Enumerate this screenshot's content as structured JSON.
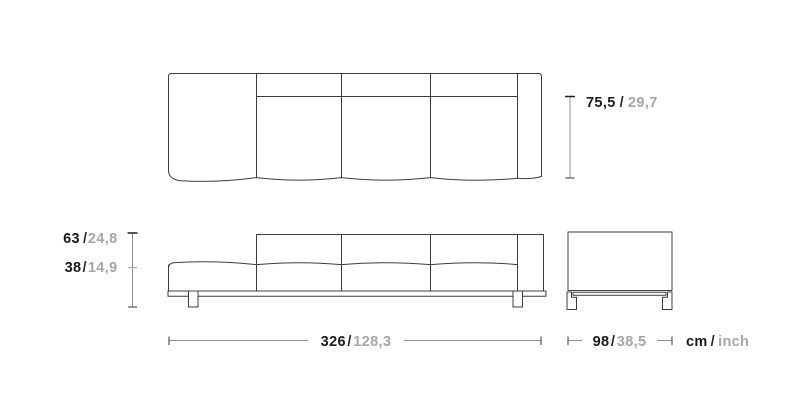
{
  "drawing": {
    "title": "sofa-dimensions-technical-drawing",
    "separator": "/",
    "units": {
      "primary": "cm",
      "secondary": "inch"
    },
    "dimensions": {
      "seat_depth": {
        "cm": "75,5",
        "inch": "29,7"
      },
      "total_height": {
        "cm": "63",
        "inch": "24,8"
      },
      "seat_height": {
        "cm": "38",
        "inch": "14,9"
      },
      "total_width": {
        "cm": "326",
        "inch": "128,3"
      },
      "side_depth": {
        "cm": "98",
        "inch": "38,5"
      }
    },
    "colors": {
      "background": "#ffffff",
      "outline": "#3c3c3c",
      "dimension_line": "#909090",
      "text_primary": "#1b1b1b",
      "text_secondary": "#a6a6a6"
    }
  }
}
